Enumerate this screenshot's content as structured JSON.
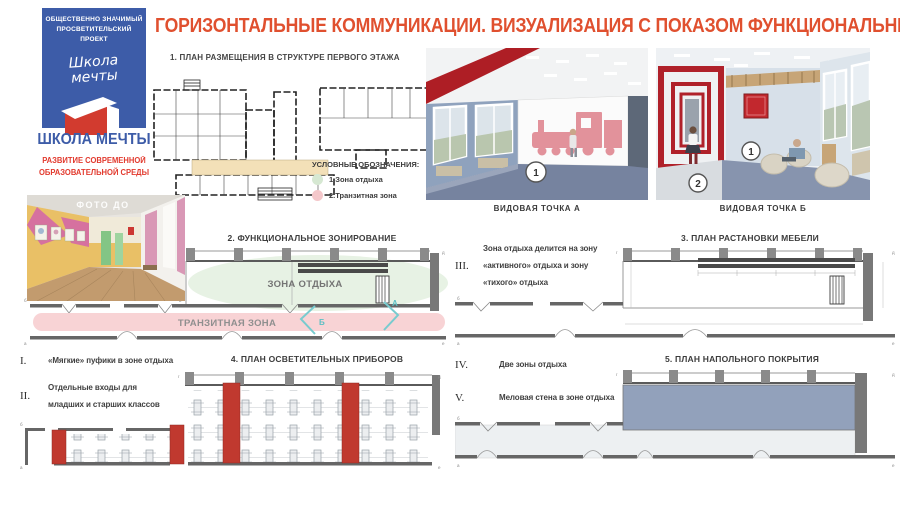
{
  "branding": {
    "badge_line1": "ОБЩЕСТВЕННО ЗНАЧИМЫЙ",
    "badge_line2": "ПРОСВЕТИТЕЛЬСКИЙ ПРОЕКТ",
    "script_line1": "Школа",
    "script_line2": "мечты",
    "org_name": "ШКОЛА МЕЧТЫ",
    "tagline": "РАЗВИТИЕ СОВРЕМЕННОЙ ОБРАЗОВАТЕЛЬНОЙ СРЕДЫ"
  },
  "title": "ГОРИЗОНТАЛЬНЫЕ КОММУНИКАЦИИ. ВИЗУАЛИЗАЦИЯ С ПОКАЗОМ ФУНКЦИОНАЛЬНЫХ ЗОН",
  "photo": {
    "label": "ФОТО ДО"
  },
  "sections": {
    "s1": "1. ПЛАН РАЗМЕЩЕНИЯ В СТРУКТУРЕ ПЕРВОГО ЭТАЖА",
    "s2": "2. ФУНКЦИОНАЛЬНОЕ ЗОНИРОВАНИЕ",
    "s3": "3. ПЛАН РАСТАНОВКИ МЕБЕЛИ",
    "s4": "4. ПЛАН ОСВЕТИТЕЛЬНЫХ ПРИБОРОВ",
    "s5": "5. ПЛАН НАПОЛЬНОГО ПОКРЫТИЯ"
  },
  "legend": {
    "title": "УСЛОВНЫЕ ОБОЗНАЧЕНИЯ:",
    "items": [
      {
        "label": "1.Зона отдыха",
        "color": "#d6e8d2"
      },
      {
        "label": "2.Транзитная зона",
        "color": "#f4c7ca"
      }
    ]
  },
  "views": {
    "a": {
      "caption": "ВИДОВАЯ ТОЧКА А",
      "marker": "1"
    },
    "b": {
      "caption": "ВИДОВАЯ ТОЧКА Б",
      "marker1": "1",
      "marker2": "2"
    }
  },
  "zones": {
    "rest": "ЗОНА ОТДЫХА",
    "transit": "ТРАНЗИТНАЯ ЗОНА",
    "camera_a": "А",
    "camera_b": "Б"
  },
  "notes": {
    "i": {
      "num": "I.",
      "text": "«Мягкие» пуфики в зоне отдыха"
    },
    "ii": {
      "num": "II.",
      "text": "Отдельные входы для младших и старших классов"
    },
    "iii": {
      "num": "III.",
      "text": "Зона отдыха делится на зону «активного» отдыха и зону «тихого» отдыха"
    },
    "iv": {
      "num": "IV.",
      "text": "Две зоны отдыха"
    },
    "v": {
      "num": "V.",
      "text": "Меловая стена в зоне отдыха"
    }
  },
  "axis": {
    "a": "а",
    "b": "б",
    "v": "в",
    "g": "г",
    "d": "д",
    "e": "е"
  },
  "colors": {
    "title_red": "#e0502f",
    "brand_blue": "#3d5ca8",
    "tagline_red": "#e23a2e",
    "rest_zone_green": "#e7f2e4",
    "transit_zone_pink": "#f8d3d5",
    "plan_red_block": "#c0392f",
    "floor_blue_gray": "#92a1bb",
    "camera_teal": "#78cbcf",
    "plan1_corridor_beige": "#f3e0b8"
  }
}
